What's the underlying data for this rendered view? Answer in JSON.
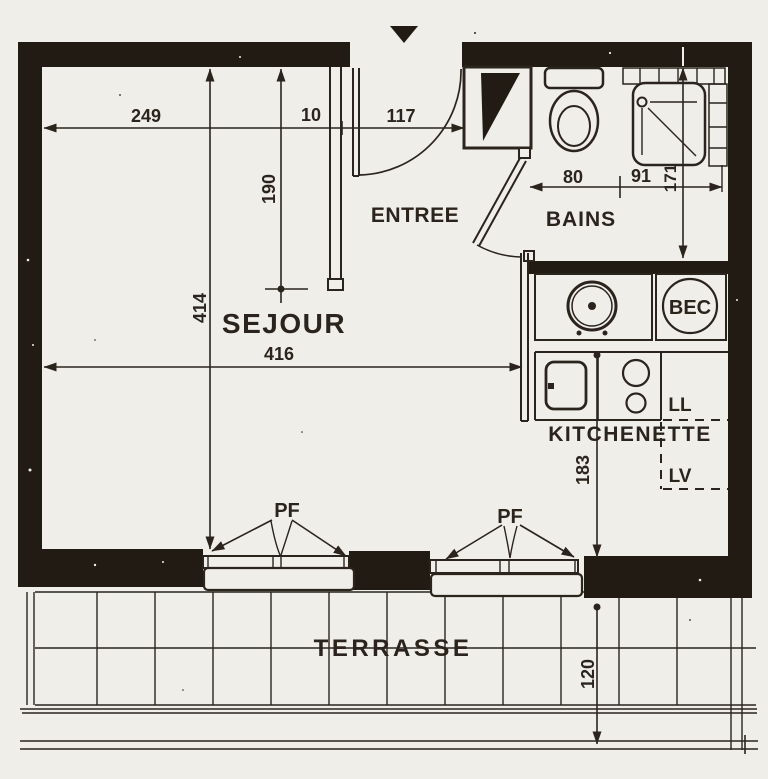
{
  "rooms": {
    "sejour": "SEJOUR",
    "entree": "ENTREE",
    "bains": "BAINS",
    "kitchenette": "KITCHENETTE",
    "terrasse": "TERRASSE"
  },
  "equipment": {
    "bec": "BEC",
    "ll": "LL",
    "lv": "LV",
    "pf_left": "PF",
    "pf_right": "PF"
  },
  "dimensions_cm": {
    "sejour_width": "249",
    "partition": "10",
    "entry": "117",
    "partition_length": "190",
    "sejour_depth": "414",
    "interior_width": "416",
    "wc": "80",
    "shower": "91",
    "bains_depth": "171",
    "kitchen_depth": "183",
    "terrace_depth": "120"
  },
  "colors": {
    "paper": "#f0eee9",
    "ink": "#2b241d",
    "wall": "#221b14"
  }
}
